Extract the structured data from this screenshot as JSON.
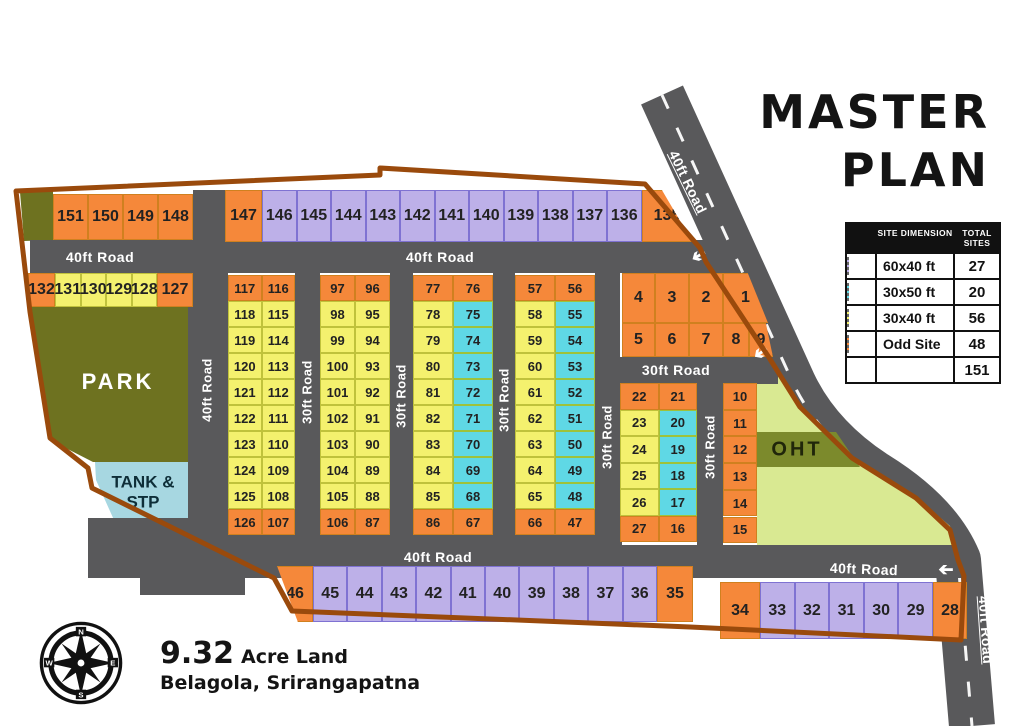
{
  "title": {
    "line1": "MASTER",
    "line2": "PLAN"
  },
  "legend": {
    "header": {
      "col1": "Site Dimension",
      "col2": "Total Sites"
    },
    "rows": [
      {
        "swatch": "purple",
        "label": "60x40 ft",
        "count": "27"
      },
      {
        "swatch": "cyan",
        "label": "30x50 ft",
        "count": "20"
      },
      {
        "swatch": "yellow",
        "label": "30x40 ft",
        "count": "56"
      },
      {
        "swatch": "orange",
        "label": "Odd Site",
        "count": "48"
      }
    ],
    "total": "151"
  },
  "footer": {
    "area_value": "9.32",
    "area_unit": "Acre Land",
    "location": "Belagola, Srirangapatna"
  },
  "compass": {
    "n": "N",
    "e": "E",
    "s": "S",
    "w": "W"
  },
  "areas": {
    "park": "PARK",
    "tank_line1": "TANK &",
    "tank_line2": "STP",
    "oht": "OHT"
  },
  "colors": {
    "orange": "#F5883A",
    "purple": "#BDB0E8",
    "cyan": "#5FD8E5",
    "yellow": "#F4F16E",
    "orange_border": "#D0801F",
    "purple_border": "#7F72D2",
    "cyan_border": "#9EC23B",
    "yellow_border": "#C0C23C",
    "road": "#59595B",
    "boundary": "#9A4A0C",
    "park": "#6E7220",
    "oht_light": "#D9E992",
    "oht_band": "#7C8A2C",
    "tank": "#A7D7E1"
  },
  "road_labels": [
    {
      "text": "40ft Road",
      "x": 100,
      "y": 257,
      "rot": 0
    },
    {
      "text": "40ft Road",
      "x": 440,
      "y": 257,
      "rot": 0
    },
    {
      "text": "40ft Road",
      "x": 207,
      "y": 390,
      "rot": -90
    },
    {
      "text": "30ft Road",
      "x": 307,
      "y": 392,
      "rot": -90
    },
    {
      "text": "30ft Road",
      "x": 401,
      "y": 396,
      "rot": -90
    },
    {
      "text": "30ft Road",
      "x": 504,
      "y": 400,
      "rot": -90
    },
    {
      "text": "30ft Road",
      "x": 607,
      "y": 437,
      "rot": -90
    },
    {
      "text": "30ft Road",
      "x": 710,
      "y": 447,
      "rot": -90
    },
    {
      "text": "30ft Road",
      "x": 676,
      "y": 370,
      "rot": 0
    },
    {
      "text": "40ft Road",
      "x": 438,
      "y": 557,
      "rot": 0
    },
    {
      "text": "40ft Road",
      "x": 864,
      "y": 569,
      "rot": 2
    },
    {
      "text": "40ft Road",
      "x": 688,
      "y": 182,
      "rot": 64
    },
    {
      "text": "40ft Road",
      "x": 986,
      "y": 630,
      "rot": 86
    }
  ],
  "plots": {
    "rows": [
      {
        "id": "row-151-148",
        "x": 53,
        "y": 194,
        "h": 46,
        "cells": [
          [
            "151",
            "o",
            35
          ],
          [
            "150",
            "o",
            35
          ],
          [
            "149",
            "o",
            35
          ],
          [
            "148",
            "o",
            35
          ]
        ]
      },
      {
        "id": "row-147-135",
        "x": 225,
        "y": 190,
        "h": 52,
        "cells": [
          [
            "147",
            "o",
            37
          ],
          [
            "146",
            "p",
            34.5
          ],
          [
            "145",
            "p",
            34.5
          ],
          [
            "144",
            "p",
            34.5
          ],
          [
            "143",
            "p",
            34.5
          ],
          [
            "142",
            "p",
            34.5
          ],
          [
            "141",
            "p",
            34.5
          ],
          [
            "140",
            "p",
            34.5
          ],
          [
            "139",
            "p",
            34.5
          ],
          [
            "138",
            "p",
            34.5
          ],
          [
            "137",
            "p",
            34.5
          ],
          [
            "136",
            "p",
            34.5
          ],
          [
            "135",
            "o",
            51
          ]
        ]
      },
      {
        "id": "row-132-127",
        "x": 28,
        "y": 273,
        "h": 34,
        "cells": [
          [
            "132",
            "o",
            27
          ],
          [
            "131",
            "y",
            25.5
          ],
          [
            "130",
            "y",
            25.5
          ],
          [
            "129",
            "y",
            25.5
          ],
          [
            "128",
            "y",
            25.5
          ],
          [
            "127",
            "o",
            36
          ]
        ]
      },
      {
        "id": "row-4-1",
        "x": 622,
        "y": 273,
        "h": 50,
        "cells": [
          [
            "4",
            "o",
            33
          ],
          [
            "3",
            "o",
            34
          ],
          [
            "2",
            "o",
            34
          ],
          [
            "1",
            "o",
            45
          ]
        ]
      },
      {
        "id": "row-5-9",
        "x": 622,
        "y": 323,
        "h": 34,
        "cells": [
          [
            "5",
            "o",
            33
          ],
          [
            "6",
            "o",
            34
          ],
          [
            "7",
            "o",
            34
          ],
          [
            "8",
            "o",
            26
          ],
          [
            "9",
            "o",
            24
          ]
        ]
      },
      {
        "id": "row-46-35",
        "x": 277,
        "y": 566,
        "h": 56,
        "cells": [
          [
            "46",
            "o",
            36
          ],
          [
            "45",
            "p",
            34.4
          ],
          [
            "44",
            "p",
            34.4
          ],
          [
            "43",
            "p",
            34.4
          ],
          [
            "42",
            "p",
            34.4
          ],
          [
            "41",
            "p",
            34.4
          ],
          [
            "40",
            "p",
            34.4
          ],
          [
            "39",
            "p",
            34.4
          ],
          [
            "38",
            "p",
            34.4
          ],
          [
            "37",
            "p",
            34.4
          ],
          [
            "36",
            "p",
            34.4
          ],
          [
            "35",
            "o",
            36
          ]
        ]
      },
      {
        "id": "row-34-28",
        "x": 720,
        "y": 582,
        "h": 57,
        "cells": [
          [
            "34",
            "o",
            40
          ],
          [
            "33",
            "p",
            34.6
          ],
          [
            "32",
            "p",
            34.6
          ],
          [
            "31",
            "p",
            34.6
          ],
          [
            "30",
            "p",
            34.6
          ],
          [
            "29",
            "p",
            34.6
          ],
          [
            "28",
            "o",
            34
          ]
        ]
      }
    ],
    "pair_blocks": [
      {
        "id": "block-117-107",
        "x": 228,
        "y": 275,
        "w": 67,
        "rowH": 26,
        "rows": [
          [
            "117",
            "o",
            "116",
            "o"
          ],
          [
            "118",
            "y",
            "115",
            "y"
          ],
          [
            "119",
            "y",
            "114",
            "y"
          ],
          [
            "120",
            "y",
            "113",
            "y"
          ],
          [
            "121",
            "y",
            "112",
            "y"
          ],
          [
            "122",
            "y",
            "111",
            "y"
          ],
          [
            "123",
            "y",
            "110",
            "y"
          ],
          [
            "124",
            "y",
            "109",
            "y"
          ],
          [
            "125",
            "y",
            "108",
            "y"
          ],
          [
            "126",
            "o",
            "107",
            "o"
          ]
        ]
      },
      {
        "id": "block-97-87",
        "x": 320,
        "y": 275,
        "w": 70,
        "rowH": 26,
        "rows": [
          [
            "97",
            "o",
            "96",
            "o"
          ],
          [
            "98",
            "y",
            "95",
            "y"
          ],
          [
            "99",
            "y",
            "94",
            "y"
          ],
          [
            "100",
            "y",
            "93",
            "y"
          ],
          [
            "101",
            "y",
            "92",
            "y"
          ],
          [
            "102",
            "y",
            "91",
            "y"
          ],
          [
            "103",
            "y",
            "90",
            "y"
          ],
          [
            "104",
            "y",
            "89",
            "y"
          ],
          [
            "105",
            "y",
            "88",
            "y"
          ],
          [
            "106",
            "o",
            "87",
            "o"
          ]
        ]
      },
      {
        "id": "block-77-67",
        "x": 413,
        "y": 275,
        "w": 80,
        "rowH": 26,
        "rows": [
          [
            "77",
            "o",
            "76",
            "o"
          ],
          [
            "78",
            "y",
            "75",
            "c"
          ],
          [
            "79",
            "y",
            "74",
            "c"
          ],
          [
            "80",
            "y",
            "73",
            "c"
          ],
          [
            "81",
            "y",
            "72",
            "c"
          ],
          [
            "82",
            "y",
            "71",
            "c"
          ],
          [
            "83",
            "y",
            "70",
            "c"
          ],
          [
            "84",
            "y",
            "69",
            "c"
          ],
          [
            "85",
            "y",
            "68",
            "c"
          ],
          [
            "86",
            "o",
            "67",
            "o"
          ]
        ]
      },
      {
        "id": "block-57-47",
        "x": 515,
        "y": 275,
        "w": 80,
        "rowH": 26,
        "rows": [
          [
            "57",
            "o",
            "56",
            "o"
          ],
          [
            "58",
            "y",
            "55",
            "c"
          ],
          [
            "59",
            "y",
            "54",
            "c"
          ],
          [
            "60",
            "y",
            "53",
            "c"
          ],
          [
            "61",
            "y",
            "52",
            "c"
          ],
          [
            "62",
            "y",
            "51",
            "c"
          ],
          [
            "63",
            "y",
            "50",
            "c"
          ],
          [
            "64",
            "y",
            "49",
            "c"
          ],
          [
            "65",
            "y",
            "48",
            "c"
          ],
          [
            "66",
            "o",
            "47",
            "o"
          ]
        ]
      },
      {
        "id": "block-22-16",
        "x": 620,
        "y": 383,
        "w": 77,
        "rowH": 26.5,
        "rows": [
          [
            "22",
            "o",
            "21",
            "o"
          ],
          [
            "23",
            "y",
            "20",
            "c"
          ],
          [
            "24",
            "y",
            "19",
            "c"
          ],
          [
            "25",
            "y",
            "18",
            "c"
          ],
          [
            "26",
            "y",
            "17",
            "c"
          ],
          [
            "27",
            "o",
            "16",
            "o"
          ]
        ]
      }
    ],
    "single_col": {
      "id": "col-10-15",
      "x": 723,
      "y": 383,
      "w": 34,
      "rowH": 26.7,
      "nums": [
        "10",
        "11",
        "12",
        "13",
        "14",
        "15"
      ]
    }
  }
}
